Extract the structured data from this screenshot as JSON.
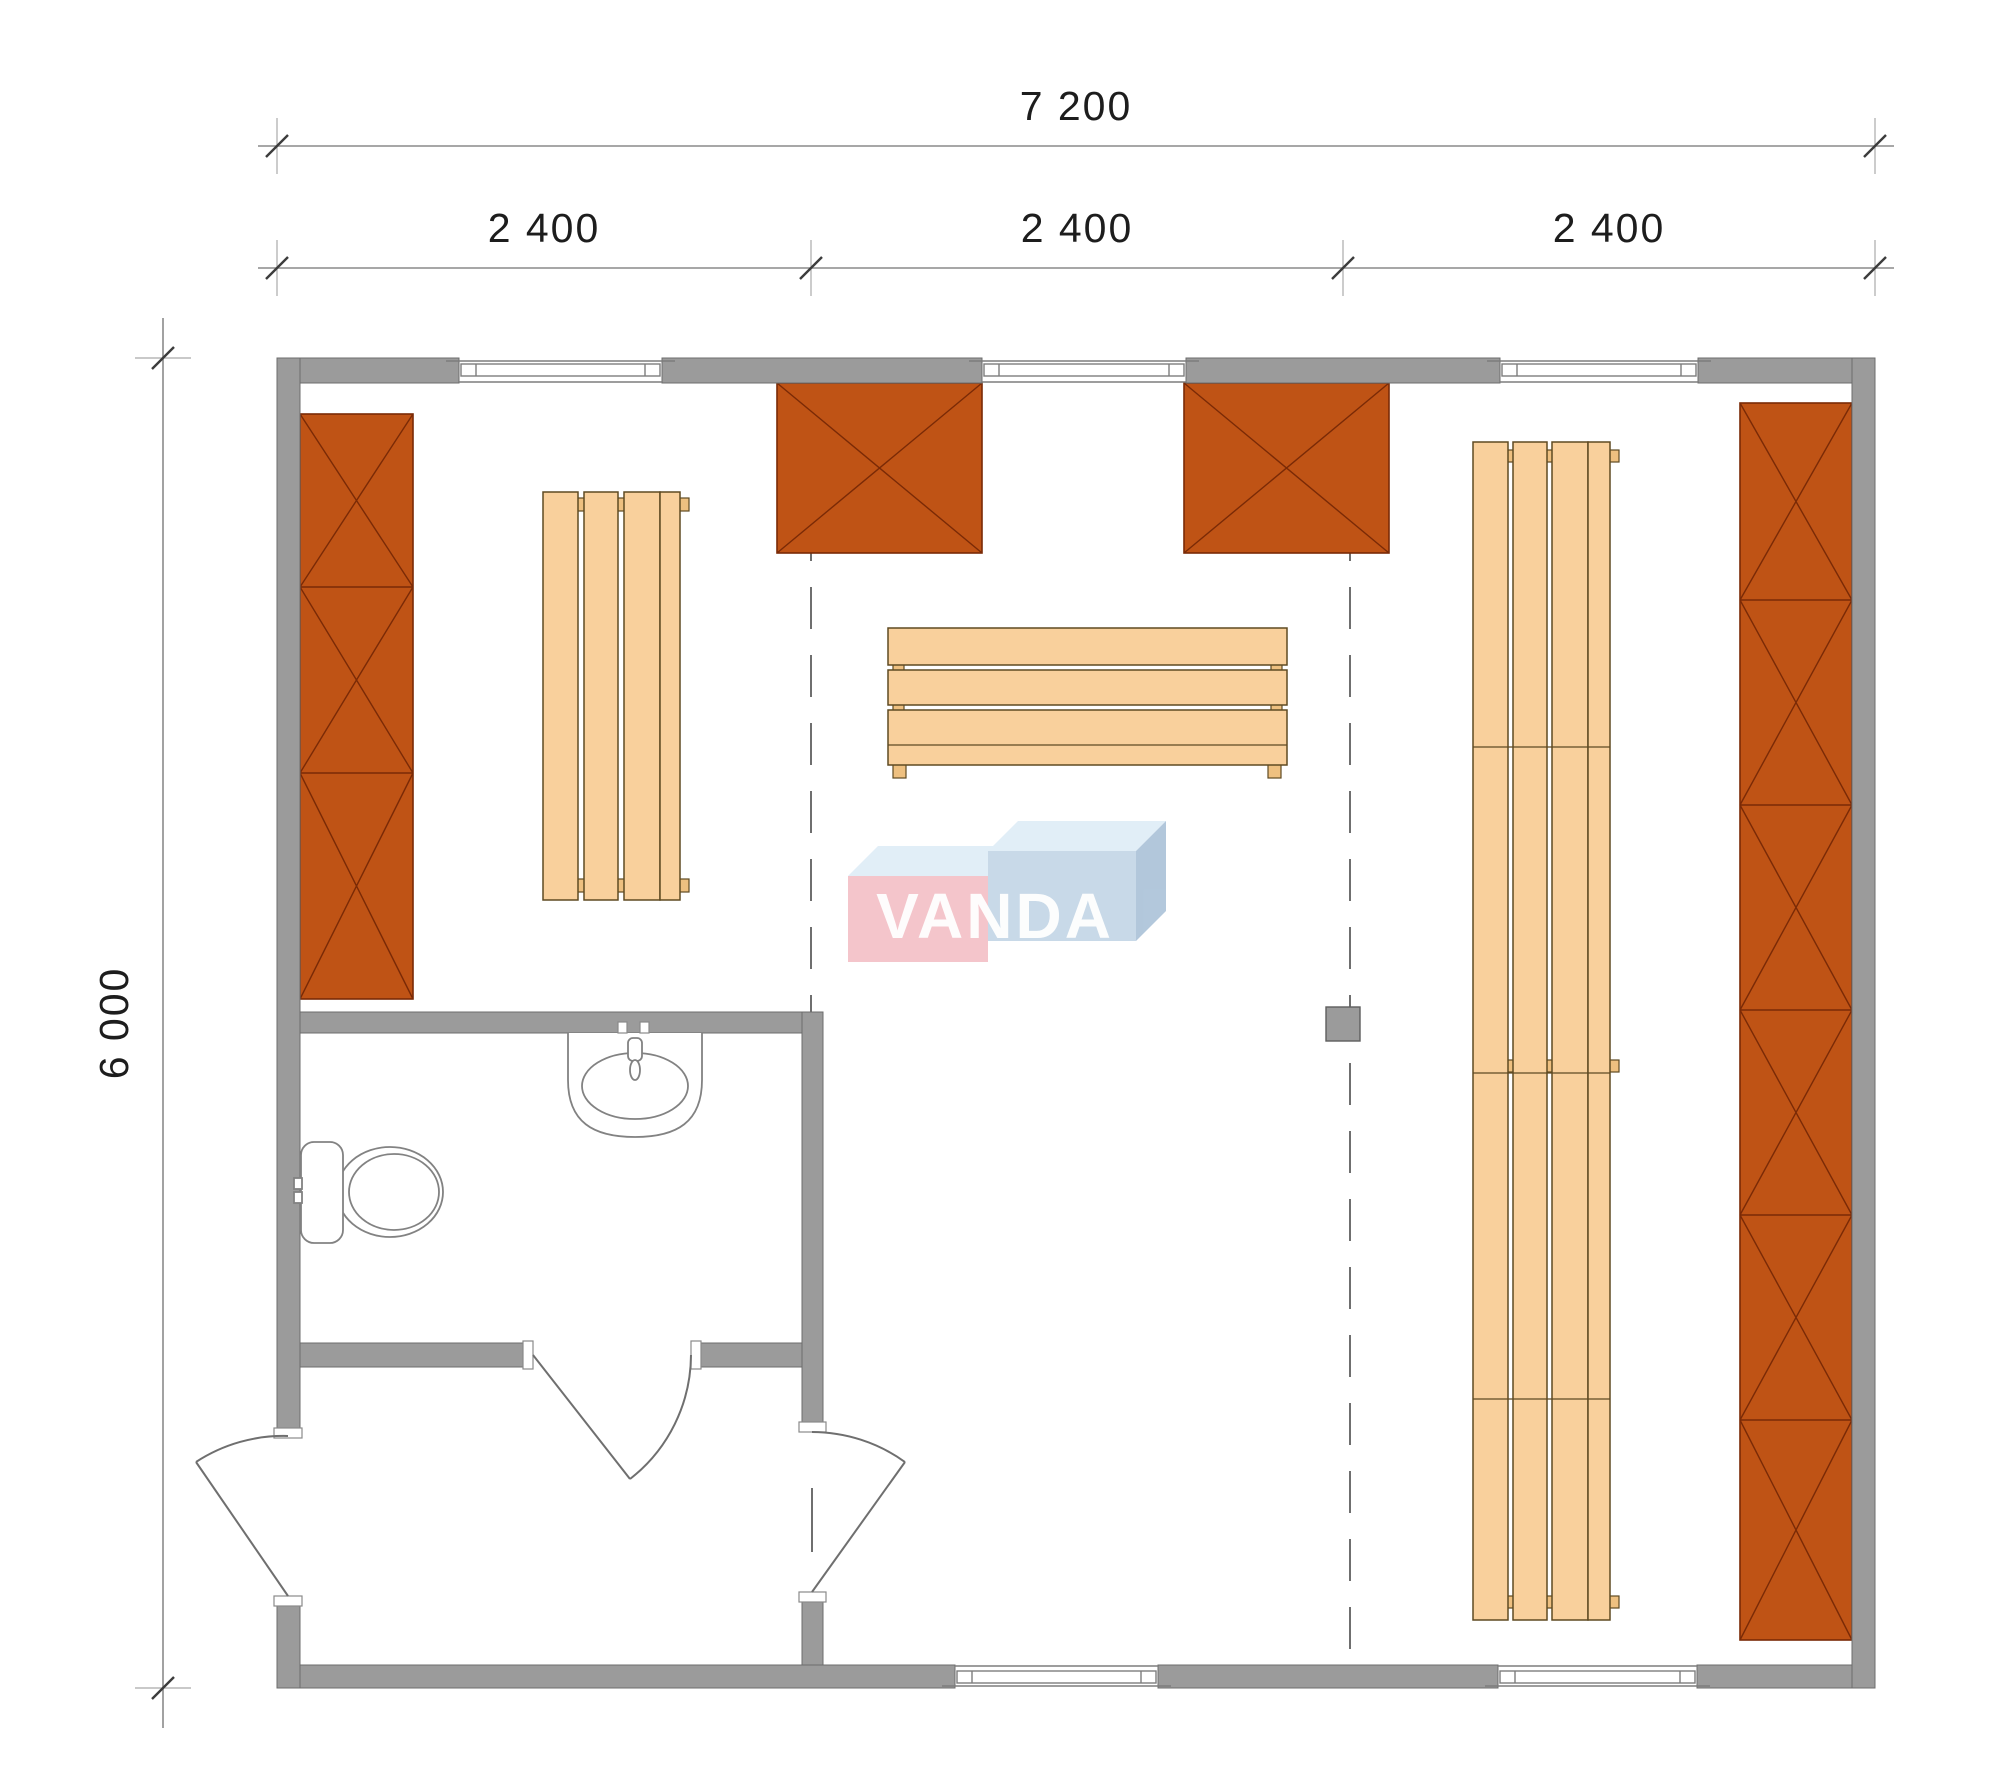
{
  "drawing": {
    "type": "floor-plan",
    "watermark_logo": {
      "text": "VANDA",
      "pink_face": "#f2b6bd",
      "blue_face": "#b9cfe2",
      "top_face": "#d9eaf5",
      "side_face": "#9db8d2",
      "letter_color": "#ffffff"
    },
    "dimensions": {
      "total_width": {
        "label": "7 200"
      },
      "width_segments": [
        {
          "label": "2 400"
        },
        {
          "label": "2 400"
        },
        {
          "label": "2 400"
        }
      ],
      "total_height": {
        "label": "6 000"
      }
    },
    "colors": {
      "wall": "#9b9b9b",
      "cabinet": "#bf5315",
      "bench_wood": "#f9d09c",
      "dimension_text": "#1d1d1d",
      "background": "#ffffff"
    },
    "elements": {
      "windows_top": 3,
      "windows_bottom": 2,
      "doors": [
        "exterior-door",
        "vestibule-door",
        "bathroom-door"
      ],
      "furniture": [
        "wall-cabinet-left",
        "heater-box-1",
        "heater-box-2",
        "wall-cabinet-right",
        "bench-left",
        "bench-middle",
        "bench-right",
        "stove-post"
      ],
      "bathroom_fixtures": [
        "toilet",
        "sink"
      ]
    }
  }
}
